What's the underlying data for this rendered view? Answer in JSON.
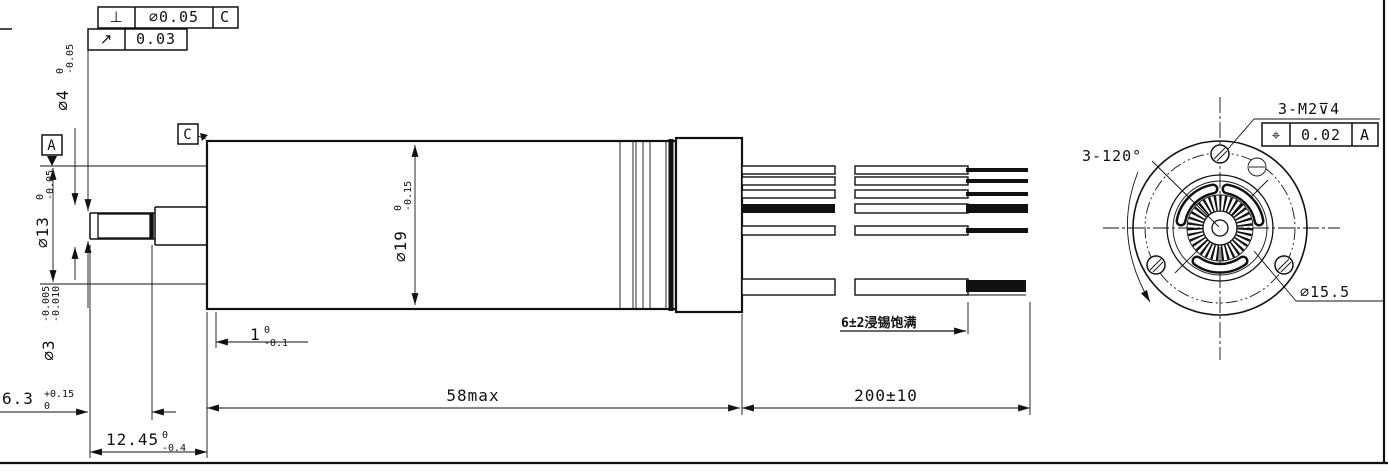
{
  "frames": {
    "perp": {
      "symbol": "⊥",
      "tolerance": "⌀0.05",
      "datum": "C"
    },
    "runout": {
      "symbol": "↗",
      "tolerance": "0.03"
    },
    "position": {
      "symbol": "⌖",
      "tolerance": "0.02",
      "datum": "A"
    }
  },
  "datums": {
    "a": "A",
    "c": "C"
  },
  "dims": {
    "shaft_d4": {
      "v": "⌀4",
      "sup": "0",
      "sub": "-0.05"
    },
    "pilot_d13": {
      "v": "⌀13",
      "sup": "0",
      "sub": "-0.05"
    },
    "shaft_d3": {
      "v": "⌀3",
      "sup": "-0.005",
      "sub": "-0.010"
    },
    "body_d19": {
      "v": "⌀19",
      "sup": "0",
      "sub": "-0.15"
    },
    "step_1": {
      "v": "1",
      "sup": "0",
      "sub": "-0.1"
    },
    "tip_6_3": {
      "v": "6.3",
      "sup": "+0.15",
      "sub": "0"
    },
    "shaft_len": {
      "v": "12.45",
      "sup": "0",
      "sub": "-0.4"
    },
    "body_len": "58max",
    "lead_len": "200±10",
    "tin_note": "6±2浸锡饱满",
    "hole_angle": "3-120°",
    "bolt_circle_d": "⌀15.5",
    "thread_note": "3-M2⊽4"
  }
}
